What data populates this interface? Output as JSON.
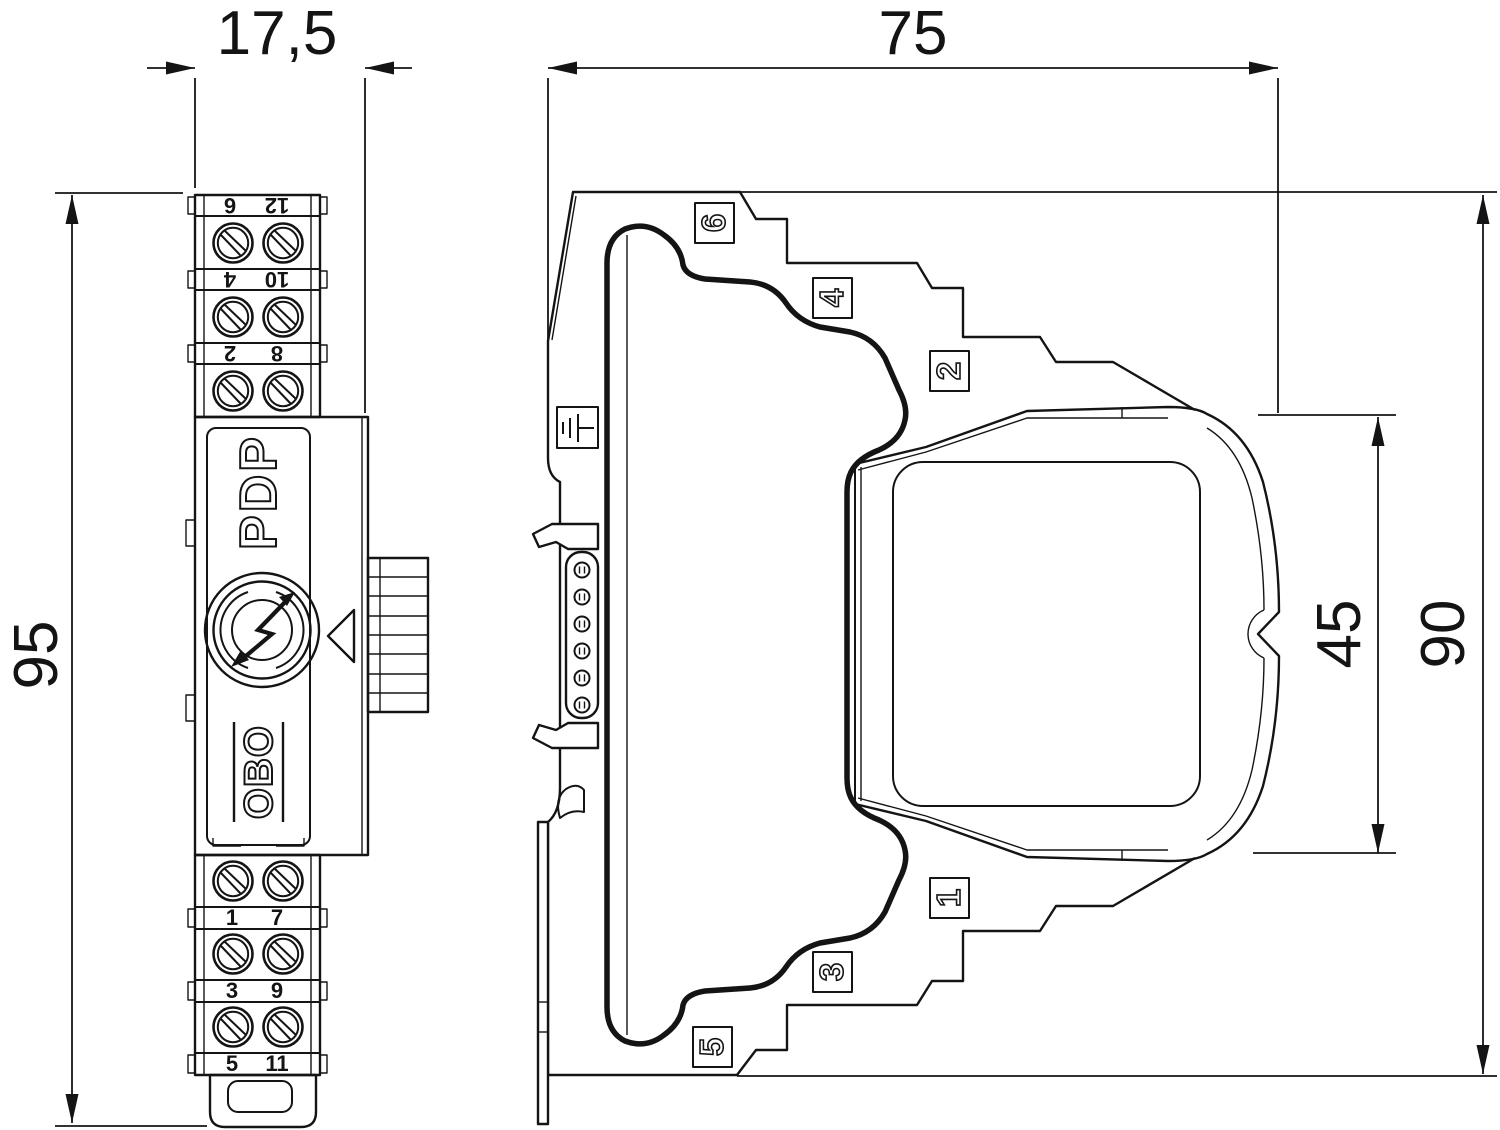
{
  "drawing": {
    "kind": "dimension-drawing",
    "line_color": "#141414",
    "background_color": "#ffffff"
  },
  "dimensions": {
    "front_width": "17,5",
    "front_height": "95",
    "side_depth": "75",
    "side_height": "90",
    "module_height": "45"
  },
  "front_view": {
    "product_name": "PDP",
    "brand": "OBO",
    "terminals_top": [
      {
        "left": "6",
        "right": "12"
      },
      {
        "left": "4",
        "right": "10"
      },
      {
        "left": "2",
        "right": "8"
      }
    ],
    "terminals_bottom": [
      {
        "left": "1",
        "right": "7"
      },
      {
        "left": "3",
        "right": "9"
      },
      {
        "left": "5",
        "right": "11"
      }
    ],
    "icons": [
      "surge-arrow-logo-icon",
      "direction-triangle-icon",
      "screw-icon"
    ]
  },
  "side_view": {
    "markers_top": [
      "6",
      "4",
      "2"
    ],
    "markers_bottom": [
      "1",
      "3",
      "5"
    ],
    "ground_marker": "earth-icon",
    "contact_pin_count": 6
  }
}
